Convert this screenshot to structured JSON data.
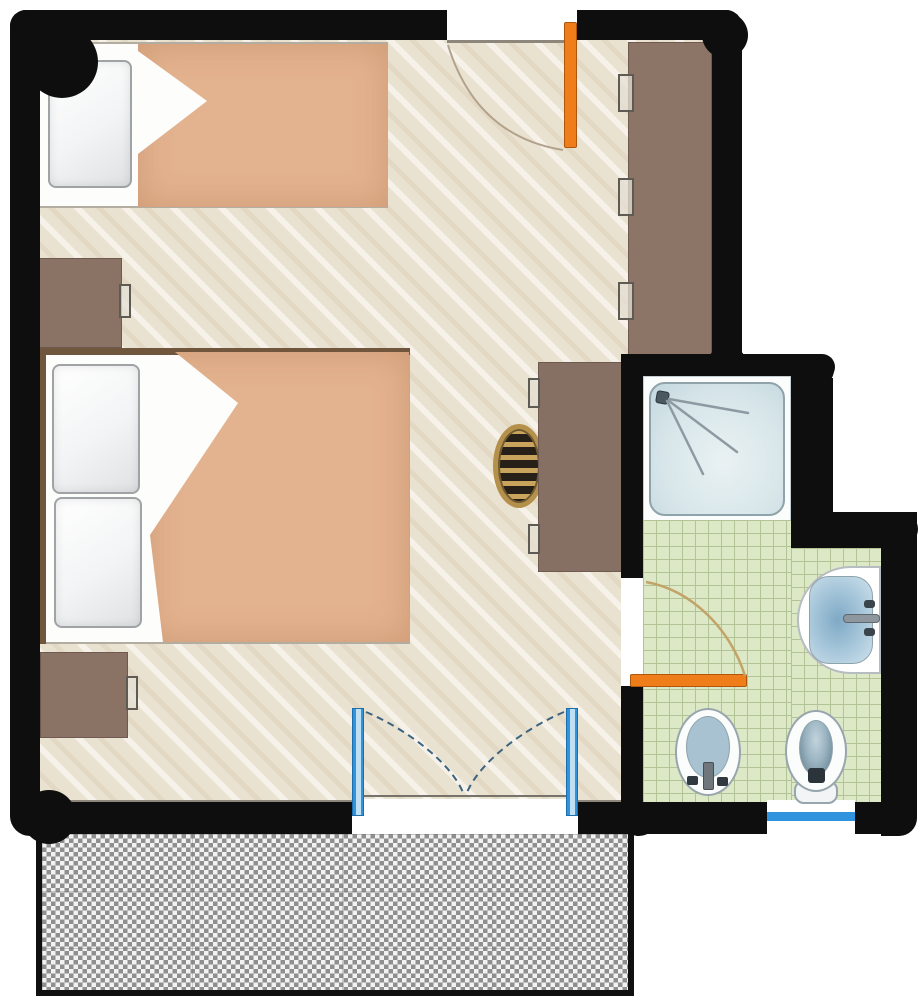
{
  "diagram": {
    "type": "floor-plan",
    "scene": "Hotel studio room: bedroom/living area with wood floor, en-suite bathroom with green tiled floor, and checkered terrace below",
    "rooms": [
      {
        "name": "bedroom",
        "floor": "light wood with diagonal grain",
        "contents": [
          "single bed",
          "double bed",
          "two nightstands",
          "wardrobe",
          "desk",
          "wicker chair"
        ]
      },
      {
        "name": "bathroom",
        "floor": "green tile grid",
        "contents": [
          "shower",
          "washbasin",
          "bidet",
          "toilet"
        ]
      },
      {
        "name": "terrace",
        "floor": "gray checkered paving"
      }
    ],
    "doors": [
      {
        "name": "entry-door",
        "location": "top wall",
        "color": "orange",
        "swing": "into bedroom"
      },
      {
        "name": "bathroom-door",
        "location": "wall between bedroom and bathroom",
        "color": "orange",
        "swing": "into bathroom"
      },
      {
        "name": "french-doors",
        "location": "bottom wall to terrace",
        "color": "blue",
        "leaves": 2,
        "swing": "both leaves into bedroom, arcs meet at center"
      }
    ],
    "windows": [
      {
        "name": "bathroom-window",
        "location": "bathroom bottom wall",
        "color": "blue"
      }
    ]
  },
  "labels": {
    "plan": "Studio room floor plan with bathroom and terrace",
    "bedroom_floor": "Bedroom / living area with light wood floor",
    "bathroom_tiles": "Bathroom with green tiled floor",
    "terrace": "Terrace with gray checkered paving",
    "exterior_wall": "Exterior wall (black)",
    "single_bed": "Single bed with pillow and folded duvet",
    "single_bed_pillow": "Pillow",
    "single_bed_blanket": "Folded duvet",
    "double_bed": "Double bed with two pillows and folded duvet",
    "double_bed_pillow": "Pillow",
    "double_bed_blanket": "Folded duvet",
    "nightstand": "Nightstand with handle",
    "wardrobe": "Wardrobe with three door handles",
    "desk": "Desk / dressing table",
    "chair": "Round wicker chair",
    "entry_door": "Entry door, orange, swings into room",
    "entry_swing": "Entry door swing arc",
    "bathroom_door": "Bathroom door, orange, swings into bathroom",
    "french_doors": "Double french doors to terrace, blue",
    "shower": "Shower tray with wall-mounted shower head",
    "shower_head": "Shower head with spray",
    "sink": "Washbasin with mixer tap",
    "bidet": "Bidet with tap",
    "toilet": "Toilet",
    "bathroom_window": "Bathroom window, blue",
    "threshold": "Door threshold"
  },
  "colors": {
    "wall": "#0e0e0e",
    "wood_floor": "#eae2d0",
    "wood_floor_stripe": "#f5efe1",
    "duvet": "#e3b28e",
    "furniture_brown": "#8a7264",
    "bed_frame_dark": "#6f563c",
    "chair_rattan": "#b4904a",
    "tile_green": "#dde8c6",
    "tile_grid": "#b2c495",
    "shower_pan": "#d9e7ea",
    "fixture_blue_gray": "#a9c2d1",
    "door_orange": "#ee7d1a",
    "window_blue": "#2f93dd",
    "swing_arc_tan": "#c2a368",
    "terrace_gray": "#8f8f8f",
    "terrace_light": "#f2f2f2"
  }
}
